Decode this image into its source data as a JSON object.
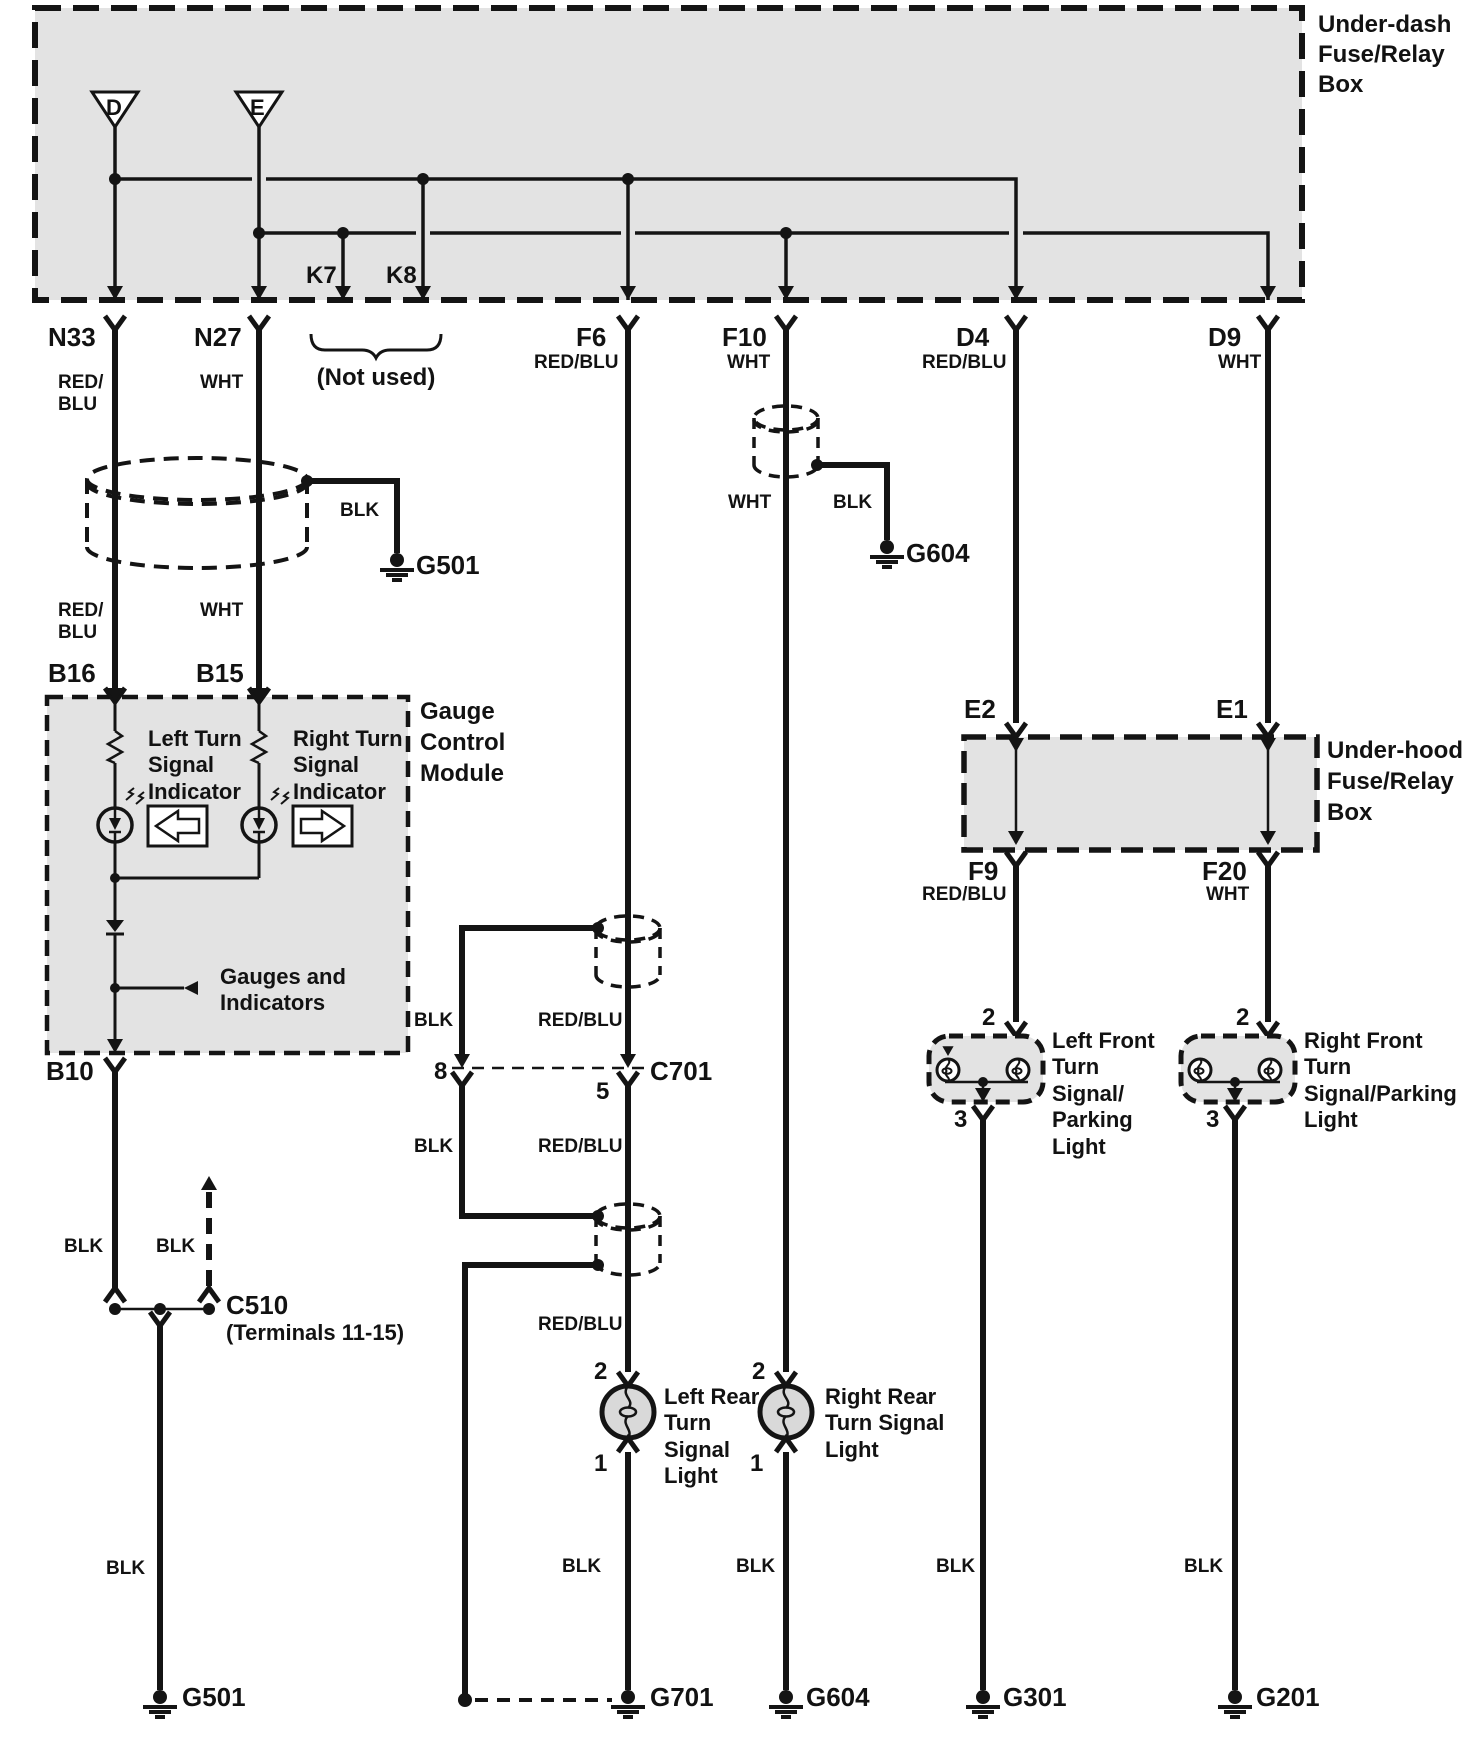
{
  "underdash": {
    "title": "Under-dash\nFuse/Relay\nBox",
    "source_d": "D",
    "source_e": "E",
    "k7": "K7",
    "k8": "K8",
    "not_used": "(Not used)",
    "n33": "N33",
    "n27": "N27",
    "f6": "F6",
    "f10": "F10",
    "d4": "D4",
    "d9": "D9"
  },
  "underhood": {
    "title": "Under-hood\nFuse/Relay\nBox",
    "e2": "E2",
    "e1": "E1",
    "f9": "F9",
    "f20": "F20"
  },
  "gauge_module": {
    "title": "Gauge\nControl\nModule",
    "b16": "B16",
    "b15": "B15",
    "b10": "B10",
    "left_indicator": "Left Turn\nSignal\nIndicator",
    "right_indicator": "Right Turn\nSignal\nIndicator",
    "gauges": "Gauges and\nIndicators"
  },
  "connectors": {
    "c510": "C510",
    "c510_note": "(Terminals 11-15)",
    "c701": "C701",
    "pin8": "8",
    "pin5": "5"
  },
  "grounds": {
    "g501": "G501",
    "g604": "G604",
    "g701": "G701",
    "g301": "G301",
    "g201": "G201"
  },
  "lights": {
    "left_rear": "Left Rear\nTurn\nSignal\nLight",
    "right_rear": "Right Rear\nTurn Signal\nLight",
    "left_front": "Left Front\nTurn\nSignal/\nParking\nLight",
    "right_front": "Right Front\nTurn\nSignal/Parking\nLight",
    "pin1": "1",
    "pin2": "2",
    "pin3": "3"
  },
  "wire_labels": {
    "red_blu": "RED/BLU",
    "red_blu_2l": "RED/\nBLU",
    "wht": "WHT",
    "blk": "BLK"
  },
  "colors": {
    "line": "#141414",
    "box_fill": "#e3e3e3",
    "bulb_fill": "#d9d9d9"
  }
}
